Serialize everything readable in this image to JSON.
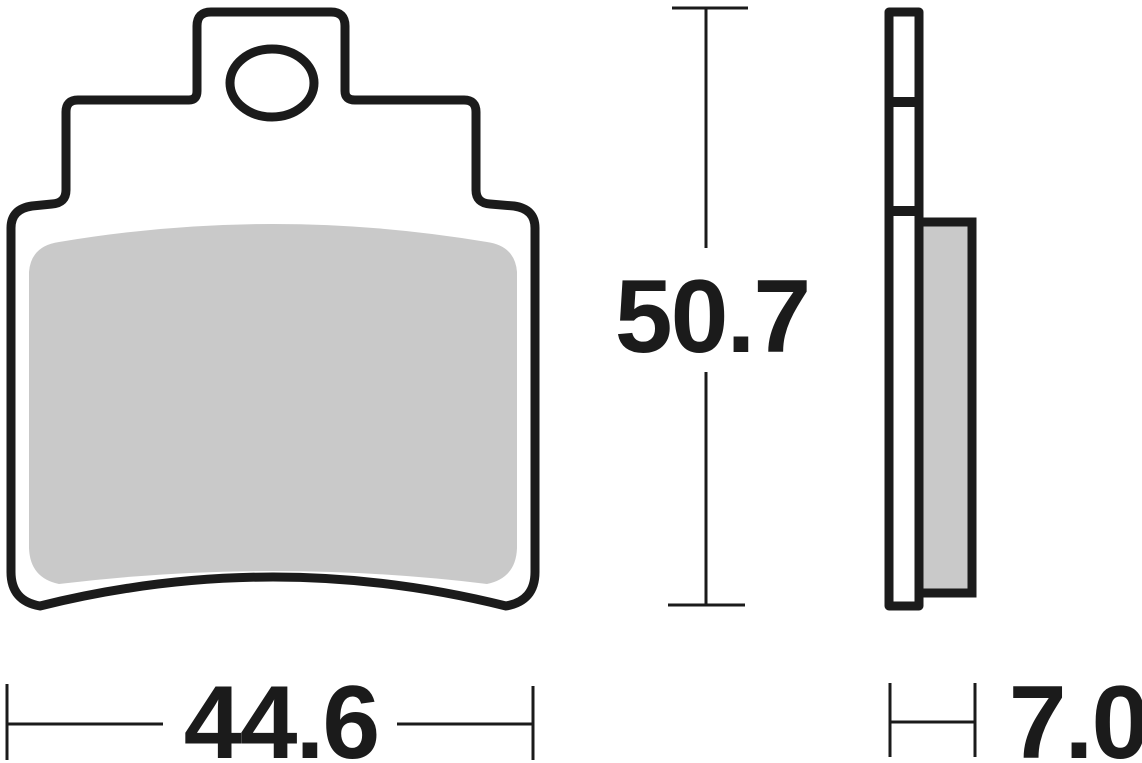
{
  "dimensions": {
    "height": {
      "value": "50.7"
    },
    "width": {
      "value": "44.6"
    },
    "thickness": {
      "value": "7.0"
    }
  },
  "colors": {
    "line": "#1b1b1b",
    "friction_material": "#c9c9c9",
    "background": "#ffffff"
  }
}
